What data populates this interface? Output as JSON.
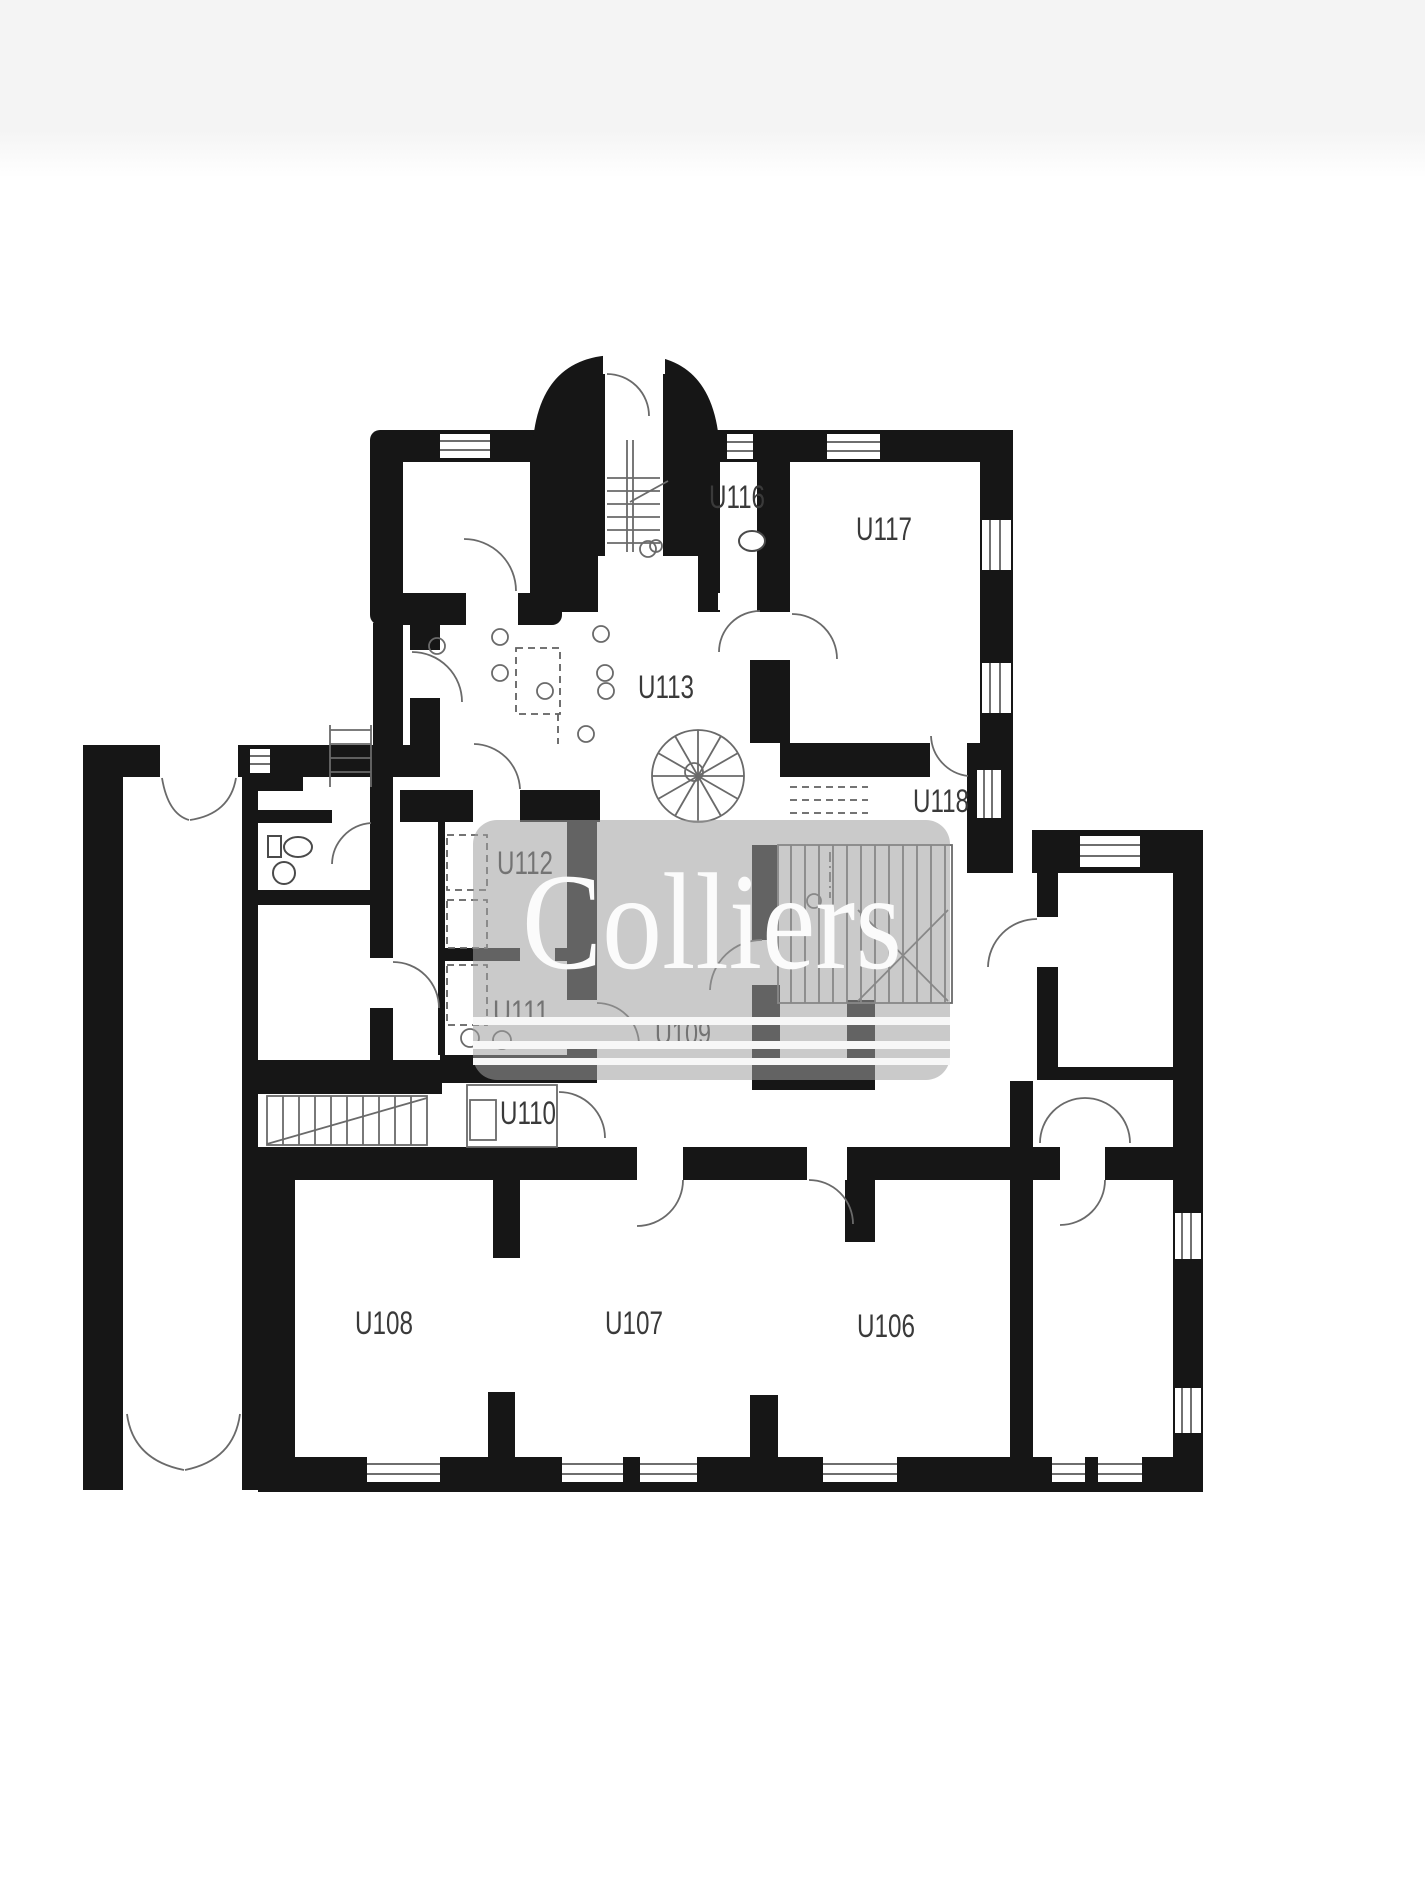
{
  "page": {
    "background": "#ffffff",
    "top_band_color": "#f4f4f4"
  },
  "watermark": {
    "text": "Colliers",
    "box_color": "#a1a1a1",
    "box_opacity": 0.56,
    "text_color": "#fbfbfb",
    "rule_color": "#f7f7f7"
  },
  "plan": {
    "wall_color": "#161616",
    "line_color": "#4a4a4a",
    "label_color": "#3a3a3a",
    "rooms": [
      {
        "id": "U116"
      },
      {
        "id": "U117"
      },
      {
        "id": "U113"
      },
      {
        "id": "U118"
      },
      {
        "id": "U112"
      },
      {
        "id": "U111"
      },
      {
        "id": "U109"
      },
      {
        "id": "U110"
      },
      {
        "id": "U108"
      },
      {
        "id": "U107"
      },
      {
        "id": "U106"
      }
    ]
  }
}
